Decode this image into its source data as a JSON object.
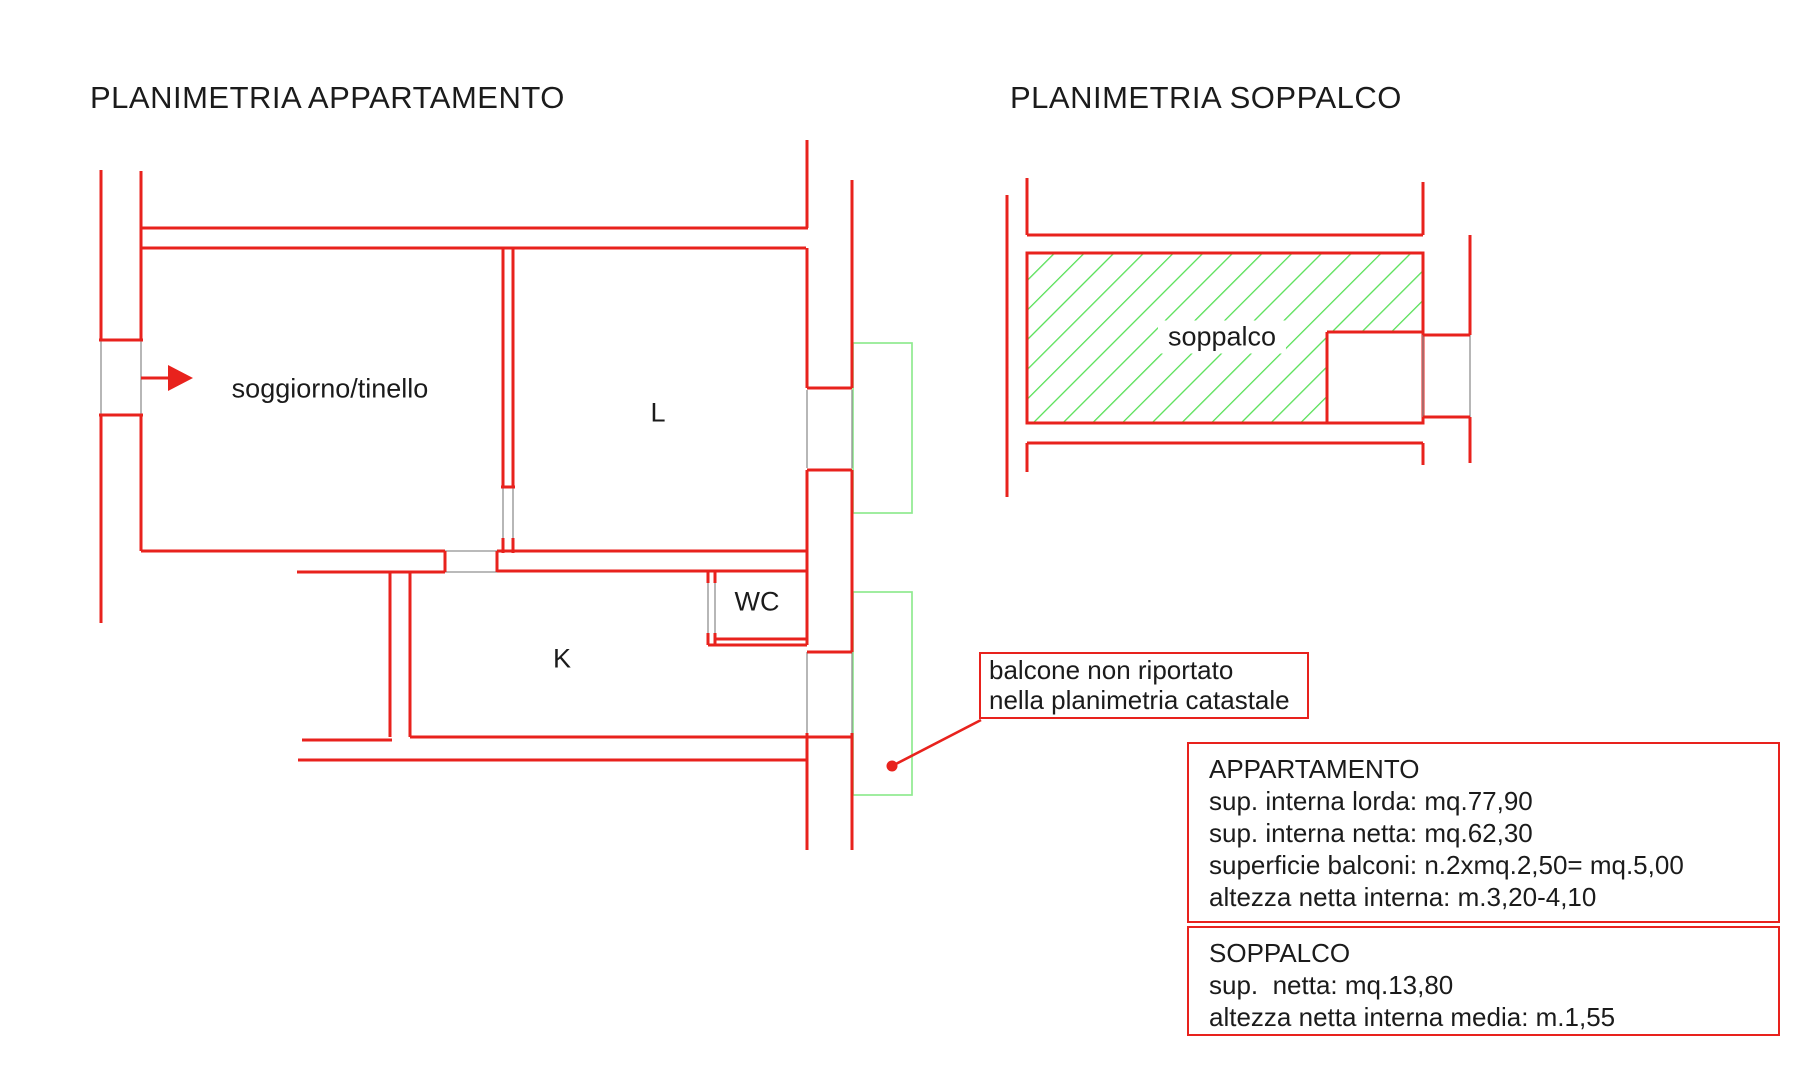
{
  "titles": {
    "apartment": "PLANIMETRIA APPARTAMENTO",
    "soppalco": "PLANIMETRIA SOPPALCO"
  },
  "rooms": {
    "soggiorno": "soggiorno/tinello",
    "l": "L",
    "k": "K",
    "wc": "WC",
    "soppalco": "soppalco"
  },
  "callout": {
    "line1": "balcone non riportato",
    "line2": "nella planimetria catastale"
  },
  "apartment_info": {
    "title": "APPARTAMENTO",
    "rows": [
      "sup. interna lorda: mq.77,90",
      "sup. interna netta: mq.62,30",
      "superficie balconi: n.2xmq.2,50= mq.5,00",
      "altezza netta interna: m.3,20-4,10"
    ]
  },
  "soppalco_info": {
    "title": "SOPPALCO",
    "rows": [
      "sup.  netta: mq.13,80",
      "altezza netta interna media: m.1,55"
    ]
  },
  "colors": {
    "wall": "#e8221d",
    "hatch": "#57e057",
    "balcony": "#90ea90",
    "opening": "#909090",
    "text": "#1b1b1b",
    "background": "#ffffff"
  }
}
